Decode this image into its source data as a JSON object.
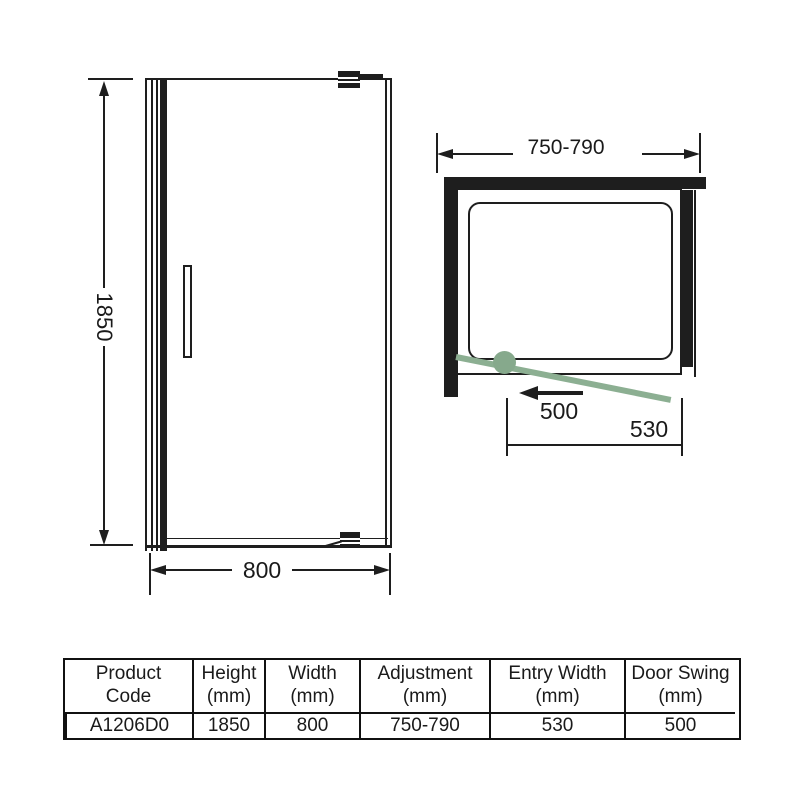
{
  "title": "Pivot shower door technical drawing",
  "front_view": {
    "height_label": "1850",
    "width_label": "800"
  },
  "top_view": {
    "adjustment_label": "750-790",
    "door_swing_label": "500",
    "entry_width_label": "530"
  },
  "table": {
    "columns": [
      {
        "line1": "Product",
        "line2": "Code",
        "value": "A1206D0"
      },
      {
        "line1": "Height",
        "line2": "(mm)",
        "value": "1850"
      },
      {
        "line1": "Width",
        "line2": "(mm)",
        "value": "800"
      },
      {
        "line1": "Adjustment",
        "line2": "(mm)",
        "value": "750-790"
      },
      {
        "line1": "Entry Width",
        "line2": "(mm)",
        "value": "530"
      },
      {
        "line1": "Door Swing",
        "line2": "(mm)",
        "value": "500"
      }
    ]
  },
  "colors": {
    "line": "#1e1e1e",
    "door_swing_green": "#8caf92"
  }
}
